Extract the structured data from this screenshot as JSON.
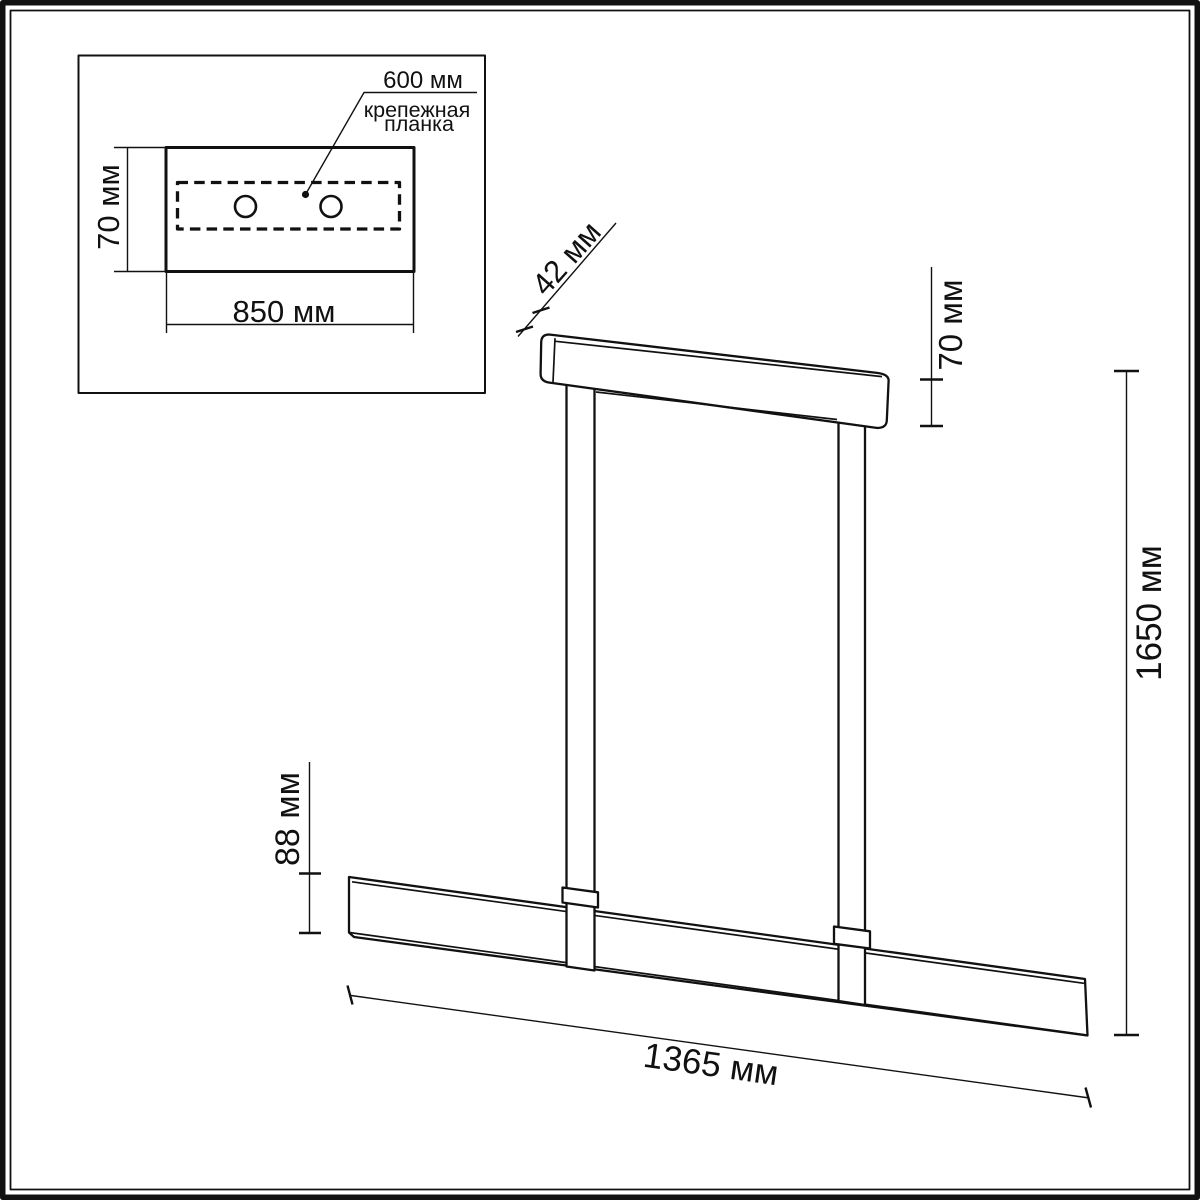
{
  "page": {
    "background": "#ffffff",
    "line_color": "#111111"
  },
  "inset": {
    "hole_spacing_label": "600 мм",
    "bracket_label_line1": "крепежная",
    "bracket_label_line2": "планка",
    "plate_height_label": "70 мм",
    "plate_width_label": "850 мм"
  },
  "fixture": {
    "canopy_depth_label": "42 мм",
    "canopy_height_label": "70 мм",
    "overall_height_label": "1650 мм",
    "bar_height_label": "88 мм",
    "bar_length_label": "1365 мм"
  }
}
